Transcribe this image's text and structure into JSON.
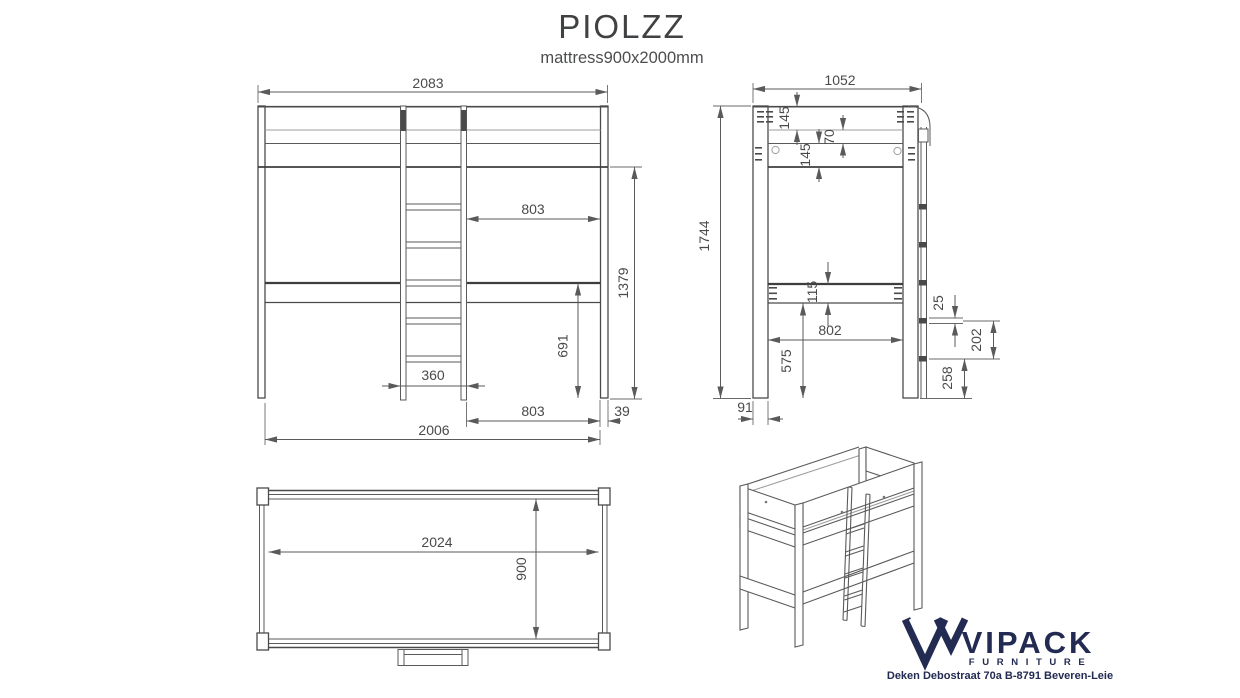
{
  "title": "PIOLZZ",
  "subtitle": "mattress900x2000mm",
  "dims": {
    "front": {
      "overall_width": "2083",
      "upper_clear_span": "803",
      "underbed_height": "1379",
      "shelf_to_floor": "691",
      "ladder_width": "360",
      "lower_clear_span": "803",
      "post_thickness": "39",
      "overall_floor_width": "2006"
    },
    "side": {
      "overall_depth": "1052",
      "top_rail_height": "145",
      "rail_gap": "70",
      "lower_rail_height": "145",
      "overall_height": "1744",
      "platform_thickness": "115",
      "inner_depth": "802",
      "under_clearance": "575",
      "rung_thickness": "25",
      "rung_spacing": "202",
      "bottom_rung_height": "258",
      "post_depth": "91"
    },
    "plan": {
      "inner_length": "2024",
      "inner_width": "900"
    }
  },
  "logo": {
    "brand": "VIPACK",
    "division": "F U R N I T U R E",
    "address": "Deken Debostraat 70a B-8791 Beveren-Leie"
  }
}
